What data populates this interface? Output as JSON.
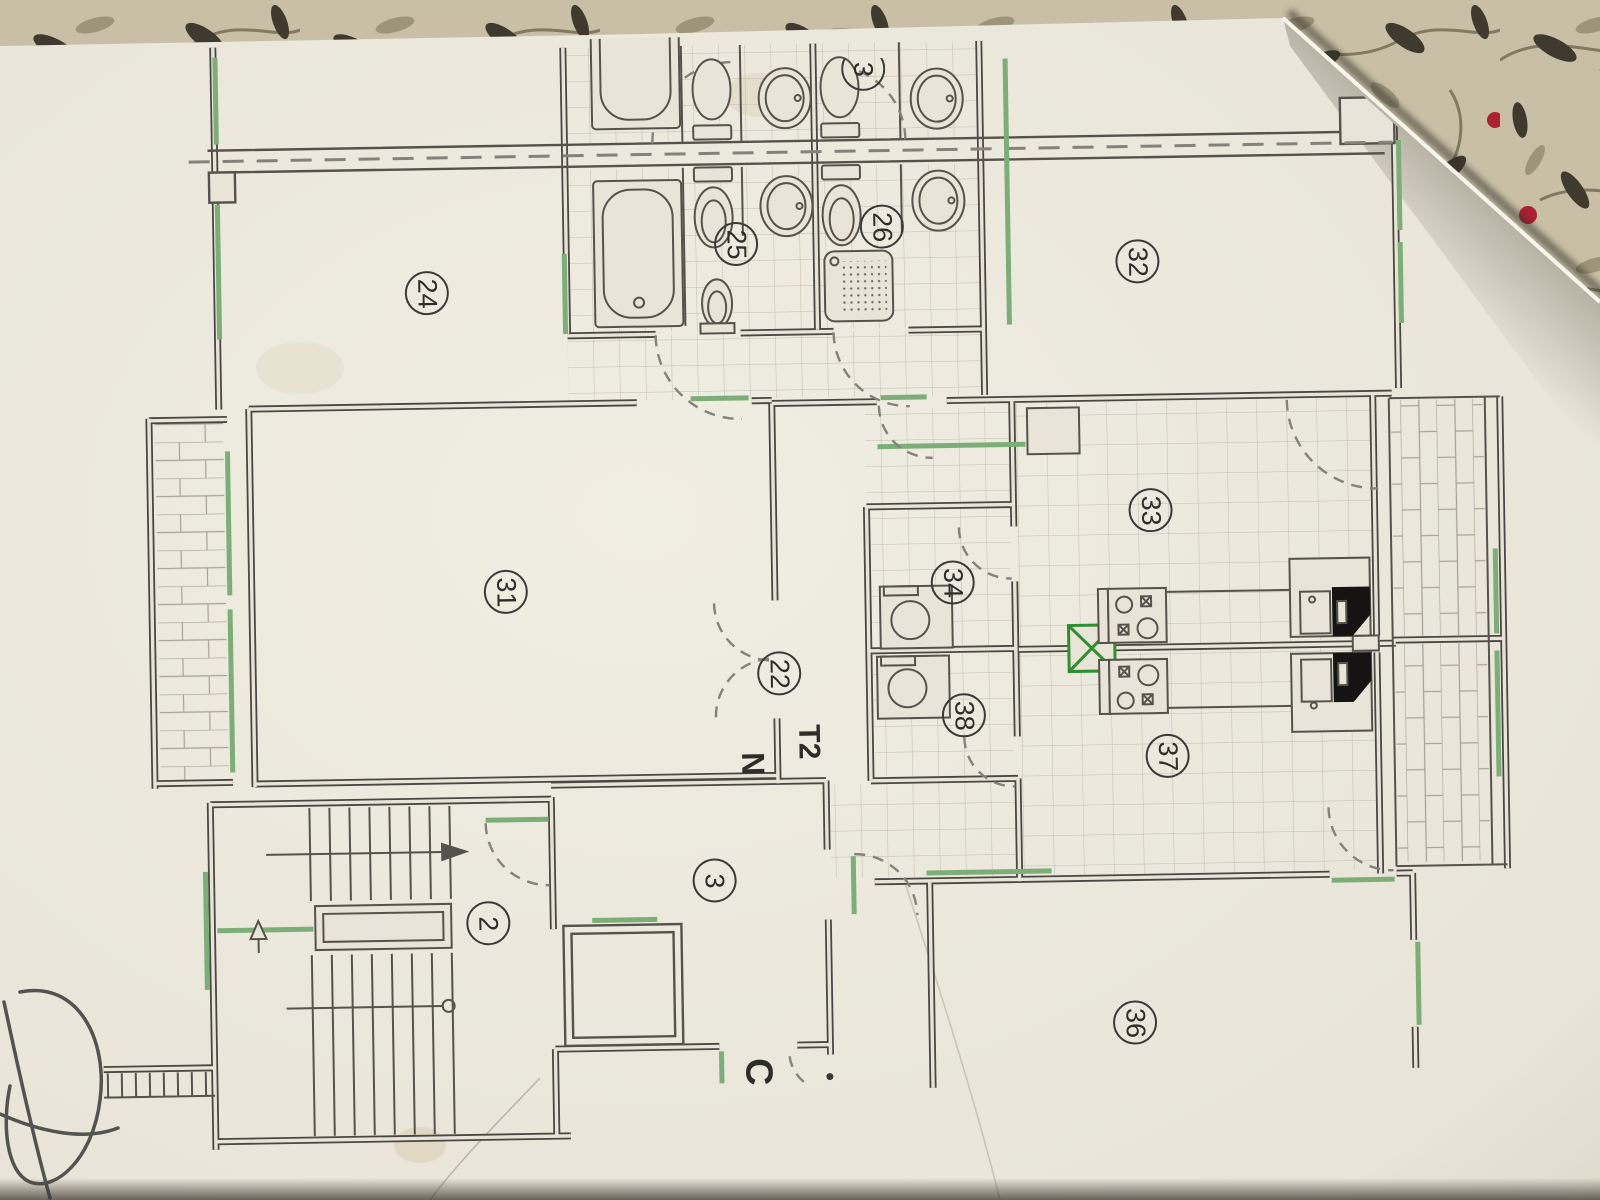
{
  "plan": {
    "rooms": [
      {
        "num": "24",
        "x": 432,
        "y": 287
      },
      {
        "num": "25",
        "x": 742,
        "y": 243
      },
      {
        "num": "26",
        "x": 888,
        "y": 228
      },
      {
        "num": "3",
        "x": 872,
        "y": 70,
        "partial": true
      },
      {
        "num": "32",
        "x": 1143,
        "y": 267
      },
      {
        "num": "31",
        "x": 506,
        "y": 587
      },
      {
        "num": "22",
        "x": 778,
        "y": 673
      },
      {
        "num": "34",
        "x": 953,
        "y": 585
      },
      {
        "num": "38",
        "x": 962,
        "y": 718
      },
      {
        "num": "33",
        "x": 1152,
        "y": 516
      },
      {
        "num": "37",
        "x": 1165,
        "y": 762
      },
      {
        "num": "2",
        "x": 483,
        "y": 918
      },
      {
        "num": "3",
        "x": 710,
        "y": 879
      },
      {
        "num": "36",
        "x": 1128,
        "y": 1028
      }
    ],
    "annotations": [
      {
        "text": "T2",
        "kind": "unit",
        "x": 806,
        "y": 742
      },
      {
        "text": "N",
        "kind": "north",
        "x": 750,
        "y": 763
      },
      {
        "text": "C",
        "kind": "entrance",
        "x": 750,
        "y": 1071
      }
    ],
    "fixtures": [
      "bathtub",
      "toilet",
      "wash-basin",
      "bidet",
      "shower-tray",
      "washing-machine",
      "stove",
      "kitchen-sink",
      "ventilation-shaft",
      "staircase",
      "elevator",
      "entrance-steps"
    ]
  },
  "colors": {
    "paper": "#e8e4d8",
    "paper_light": "#f0ede2",
    "paper_dark": "#d6d1c2",
    "wall": "#4a4843",
    "line_thin": "#55534c",
    "green": "#7dae77",
    "green_dark": "#2f8f2f",
    "tile": "#c2bcae",
    "brick": "#a8a295",
    "dash": "#83827b",
    "fabric": "#c9bfa7",
    "fabric_leaf": "#3f3a2d",
    "fabric_leaf_light": "#948a6e",
    "fabric_stem": "#7a7258",
    "fabric_berry": "#ae2135",
    "ink": "#3a3a38",
    "label": "#2e2d29",
    "black_fixture": "#151412"
  }
}
